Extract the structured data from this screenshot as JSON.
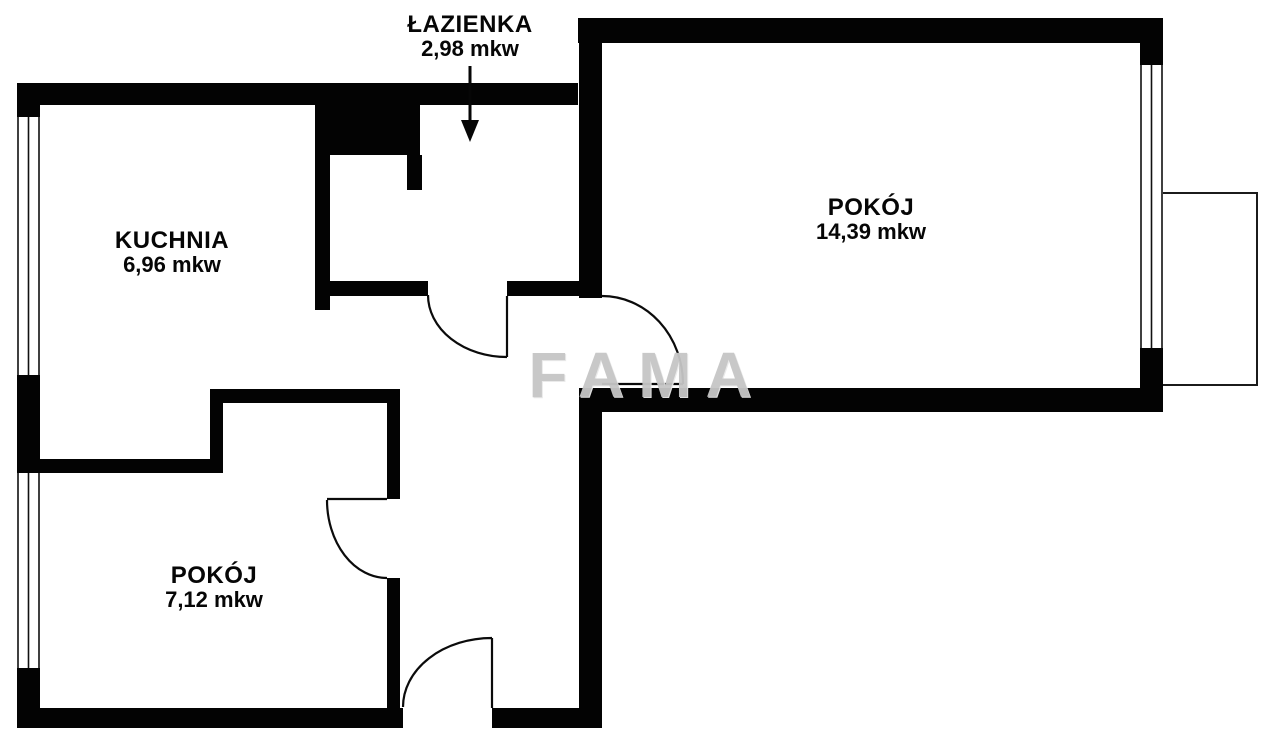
{
  "watermark": "FAMA",
  "units": "mkw",
  "rooms": [
    {
      "id": "lazienka",
      "name": "ŁAZIENKA",
      "area": "2,98 mkw"
    },
    {
      "id": "kuchnia",
      "name": "KUCHNIA",
      "area": "6,96 mkw"
    },
    {
      "id": "pokoj-large",
      "name": "POKÓJ",
      "area": "14,39 mkw"
    },
    {
      "id": "pokoj-small",
      "name": "POKÓJ",
      "area": "7,12 mkw"
    }
  ],
  "colors": {
    "walls": "#000000",
    "background": "#ffffff",
    "watermark": "#c6c6c6",
    "door_lines": "#0b0b0b"
  }
}
